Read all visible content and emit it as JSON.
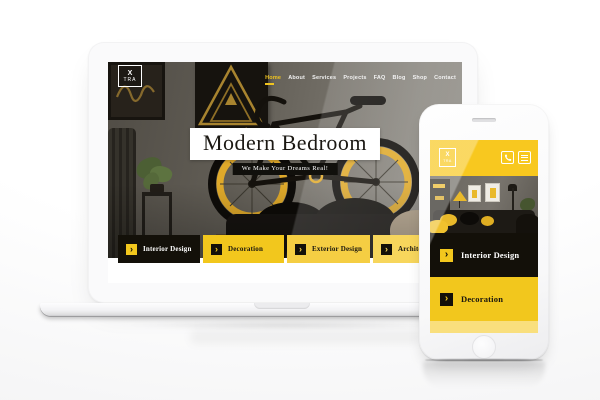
{
  "brand": {
    "logo_line1": "X",
    "logo_line2": "TRA"
  },
  "glyphs": {
    "arrow": "›"
  },
  "laptop": {
    "nav": {
      "items": [
        {
          "label": "Home",
          "active": true
        },
        {
          "label": "About"
        },
        {
          "label": "Services"
        },
        {
          "label": "Projects"
        },
        {
          "label": "FAQ"
        },
        {
          "label": "Blog"
        },
        {
          "label": "Shop"
        },
        {
          "label": "Contact"
        }
      ]
    },
    "hero": {
      "title": "Modern Bedroom",
      "tagline": "We Make Your Dreams Real!"
    },
    "categories": [
      {
        "label": "Interior Design"
      },
      {
        "label": "Decoration"
      },
      {
        "label": "Exterior Design"
      },
      {
        "label": "Architecture"
      }
    ]
  },
  "phone": {
    "header": {
      "icons": [
        {
          "name": "phone-icon"
        },
        {
          "name": "menu-icon"
        }
      ]
    },
    "categories": [
      {
        "label": "Interior Design"
      },
      {
        "label": "Decoration"
      }
    ]
  },
  "colors": {
    "accent_yellow": "#F2C71D",
    "accent_yellow_light": "#F5CE43",
    "accent_yellow_lighter": "#F7D65C",
    "accent_yellow_pale": "#F9DF7D",
    "block_black": "#131009",
    "phone_header_yellow": "#F8C81F"
  }
}
